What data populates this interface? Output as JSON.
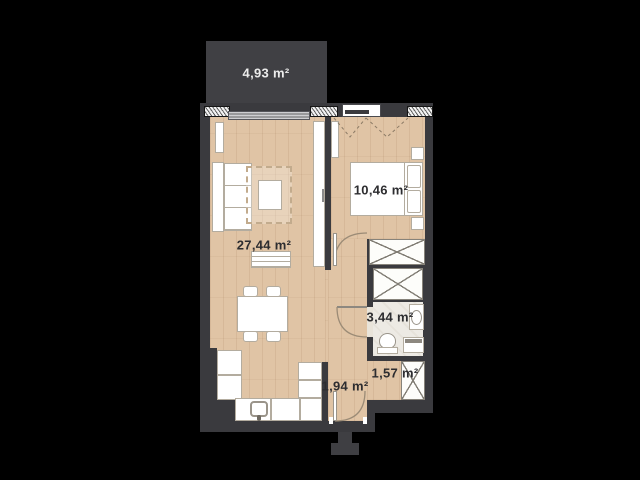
{
  "plan": {
    "balcony": {
      "area": "4,93 m²"
    },
    "living_room": {
      "area": "27,44 m²"
    },
    "bedroom": {
      "area": "10,46 m²"
    },
    "bathroom": {
      "area": "3,44 m²"
    },
    "hall": {
      "area": "1,94 m²"
    },
    "wardrobe": {
      "area": "1,57 m²"
    },
    "colors": {
      "background": "#000000",
      "wall": "#3a3a3e",
      "balcony_fill": "#404044",
      "wood_floor": "#e0c4a5",
      "bathroom_floor": "#edeae4",
      "furniture": "#ffffff",
      "label_dark": "#2d2d30",
      "label_light": "#ececec"
    }
  }
}
